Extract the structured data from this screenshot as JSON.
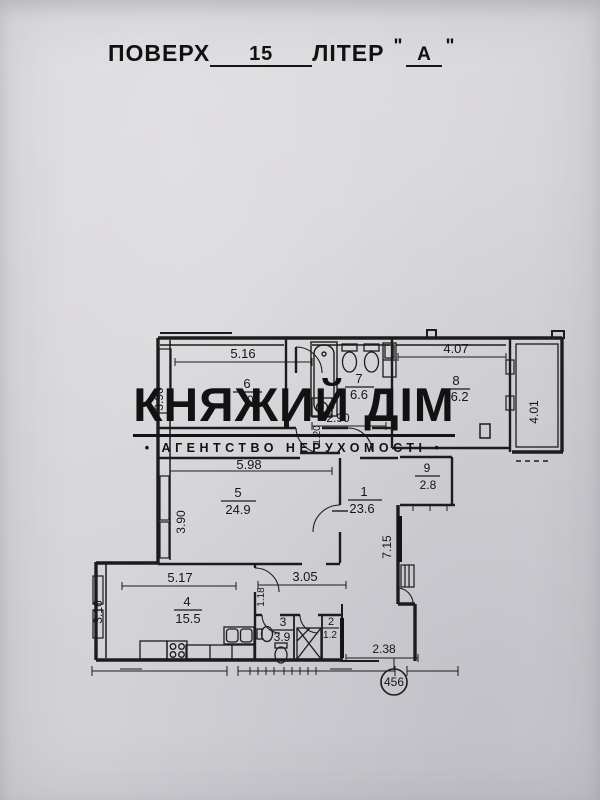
{
  "header": {
    "floor_label": "ПОВЕРХ",
    "floor_value": "15",
    "liter_label": "ЛІТЕР",
    "quote_open": "\"",
    "liter_value": "А",
    "quote_close": "\""
  },
  "watermark": {
    "title": "КНЯЖИЙ ДІМ",
    "subtitle": "• АГЕНТСТВО НЕРУХОМОСТІ •"
  },
  "plan": {
    "unit_circle": "456",
    "rooms": {
      "r1": {
        "num": "1",
        "area": "23.6"
      },
      "r2": {
        "num": "2",
        "area": "1.2"
      },
      "r3": {
        "num": "3",
        "area": "3.9"
      },
      "r4": {
        "num": "4",
        "area": "15.5"
      },
      "r5": {
        "num": "5",
        "area": "24.9"
      },
      "r6": {
        "num": "6",
        "area": "0."
      },
      "r7": {
        "num": "7",
        "area": "6.6"
      },
      "r8": {
        "num": "8",
        "area": "16.2"
      },
      "r9": {
        "num": "9",
        "area": "2.8"
      }
    },
    "dims": {
      "d516": "5.16",
      "d407": "4.07",
      "d401": "4.01",
      "d390_top": "3.90",
      "d290": "2.90",
      "d120": "1.20",
      "d598": "5.98",
      "d390_room5": "3.90",
      "d715": "7.15",
      "d517": "5.17",
      "d305": "3.05",
      "d316": "3.16",
      "d118": "1.18",
      "d238": "2.38"
    }
  }
}
